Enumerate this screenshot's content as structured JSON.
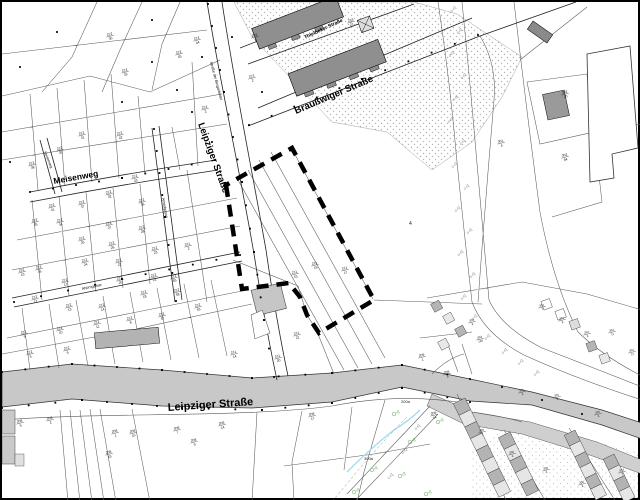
{
  "map": {
    "type": "cadastral-parcel-map",
    "streets": [
      {
        "id": "leipziger-upper",
        "label": "Leipziger Straße",
        "x": 196,
        "y": 122,
        "rotate": 70,
        "size": 9.5,
        "weight": "bold"
      },
      {
        "id": "leipziger-lower",
        "label": "Leipziger Straße",
        "x": 166,
        "y": 409,
        "rotate": -4,
        "size": 11,
        "weight": "bold"
      },
      {
        "id": "meisenweg",
        "label": "Meisenweg",
        "x": 52,
        "y": 182,
        "rotate": -10,
        "size": 8.5,
        "weight": "bold"
      },
      {
        "id": "braussweiger",
        "label": "Braußwiger Straße",
        "x": 294,
        "y": 112,
        "rotate": -23,
        "size": 9.5,
        "weight": "bold"
      },
      {
        "id": "thielbeker",
        "label": "Thielbeker Straße",
        "x": 303,
        "y": 37,
        "rotate": -25,
        "size": 5,
        "weight": "bold"
      },
      {
        "id": "bergarbeiter",
        "label": "Straße der Bergarbeiter",
        "x": 208,
        "y": 60,
        "rotate": 75,
        "size": 3.8,
        "weight": "normal"
      },
      {
        "id": "amselgasse",
        "label": "Amselgasse",
        "x": 160,
        "y": 196,
        "rotate": 80,
        "size": 3.8,
        "weight": "normal"
      },
      {
        "id": "ahorngasse",
        "label": "Ahorngasse",
        "x": 80,
        "y": 288,
        "rotate": -12,
        "size": 3.8,
        "weight": "normal"
      },
      {
        "id": "meisenweg-lane",
        "label": "Meisenweg",
        "x": 42,
        "y": 150,
        "rotate": 68,
        "size": 3.5,
        "weight": "normal"
      }
    ],
    "area_labels": [
      {
        "t": "4",
        "x": 407,
        "y": 223,
        "s": 5
      },
      {
        "t": "200a",
        "x": 399,
        "y": 401,
        "s": 4
      },
      {
        "t": "300a",
        "x": 362,
        "y": 458,
        "s": 4
      }
    ],
    "parcels": [
      [
        108,
        34,
        "212/30"
      ],
      [
        123,
        70,
        "212/33"
      ],
      [
        80,
        133,
        "212/31"
      ],
      [
        118,
        133,
        "212/42"
      ],
      [
        58,
        148,
        "212/39"
      ],
      [
        30,
        163,
        "212/38"
      ],
      [
        133,
        176,
        "212/43"
      ],
      [
        50,
        205,
        "212/41"
      ],
      [
        107,
        192,
        "212/32"
      ],
      [
        140,
        200,
        "212/36"
      ],
      [
        80,
        202,
        "212/37"
      ],
      [
        33,
        220,
        "212/35"
      ],
      [
        58,
        220,
        "212/34"
      ],
      [
        107,
        223,
        "212/27"
      ],
      [
        140,
        227,
        "212/28"
      ],
      [
        80,
        238,
        "212/25"
      ],
      [
        110,
        243,
        "212/26"
      ],
      [
        153,
        248,
        "212/23"
      ],
      [
        117,
        260,
        "212/22"
      ],
      [
        83,
        260,
        "212/24"
      ],
      [
        37,
        267,
        "212/16"
      ],
      [
        20,
        270,
        "212/15"
      ],
      [
        63,
        280,
        "212/17"
      ],
      [
        118,
        278,
        "212/20"
      ],
      [
        152,
        275,
        "212/21"
      ],
      [
        172,
        276,
        "212/55"
      ],
      [
        186,
        244,
        "211/2"
      ],
      [
        33,
        297,
        "212/12"
      ],
      [
        67,
        305,
        "212/13"
      ],
      [
        100,
        305,
        "212/14"
      ],
      [
        142,
        292,
        "212/18"
      ],
      [
        175,
        290,
        "212/58"
      ],
      [
        22,
        332,
        "212/9"
      ],
      [
        58,
        328,
        "212/10"
      ],
      [
        95,
        322,
        "212/11"
      ],
      [
        128,
        318,
        "212/8"
      ],
      [
        160,
        314,
        "212/57"
      ],
      [
        28,
        352,
        "212/5"
      ],
      [
        65,
        348,
        "212/6"
      ],
      [
        196,
        305,
        "212/53"
      ],
      [
        177,
        52,
        "212/45"
      ],
      [
        195,
        38,
        "212/44"
      ],
      [
        253,
        35,
        "202/2"
      ],
      [
        250,
        76,
        "213/2"
      ],
      [
        203,
        107,
        "214/2"
      ],
      [
        232,
        352,
        "211/14"
      ],
      [
        276,
        356,
        "211/20"
      ],
      [
        295,
        333,
        "211/21"
      ],
      [
        293,
        272,
        "211/15"
      ],
      [
        313,
        263,
        "211/16"
      ],
      [
        343,
        268,
        "211/17"
      ],
      [
        349,
        20,
        "218/27"
      ],
      [
        563,
        92,
        "302/20"
      ],
      [
        563,
        155,
        "302/84"
      ],
      [
        499,
        141,
        "301/4"
      ],
      [
        18,
        421,
        "208/5"
      ],
      [
        48,
        418,
        "208/2"
      ],
      [
        113,
        431,
        "208/1"
      ],
      [
        131,
        431,
        "208/10"
      ],
      [
        175,
        428,
        "208/7"
      ],
      [
        220,
        423,
        "208/14"
      ],
      [
        310,
        414,
        "208/17"
      ],
      [
        107,
        452,
        "208/19"
      ],
      [
        192,
        440,
        "208/9"
      ],
      [
        445,
        372,
        "209/4"
      ],
      [
        432,
        413,
        "209/14"
      ],
      [
        478,
        337,
        "303/139"
      ],
      [
        420,
        355,
        "209/1"
      ],
      [
        540,
        305,
        "304/7"
      ],
      [
        560,
        318,
        "304/8"
      ],
      [
        585,
        332,
        "304/9"
      ],
      [
        470,
        320,
        "303/9"
      ],
      [
        520,
        390,
        "305/3"
      ],
      [
        555,
        395,
        "305/4"
      ],
      [
        596,
        412,
        "305/6"
      ],
      [
        480,
        430,
        "306/2"
      ],
      [
        510,
        452,
        "306/4"
      ],
      [
        544,
        468,
        "306/6"
      ],
      [
        580,
        482,
        "306/8"
      ],
      [
        620,
        470,
        "307/2"
      ],
      [
        610,
        330,
        "304/11"
      ],
      [
        630,
        350,
        "304/12"
      ]
    ],
    "boundary_polygon": [
      [
        224,
        183
      ],
      [
        240,
        287
      ],
      [
        287,
        281
      ],
      [
        298,
        295
      ],
      [
        305,
        313
      ],
      [
        317,
        331
      ],
      [
        372,
        298
      ],
      [
        290,
        146
      ]
    ],
    "trees_gray": [
      [
        449,
        10
      ],
      [
        455,
        32
      ],
      [
        447,
        55
      ],
      [
        459,
        77
      ],
      [
        451,
        99
      ],
      [
        446,
        121
      ],
      [
        458,
        143
      ],
      [
        450,
        166
      ],
      [
        462,
        188
      ],
      [
        453,
        210
      ],
      [
        465,
        232
      ],
      [
        456,
        254
      ],
      [
        468,
        276
      ],
      [
        459,
        298
      ],
      [
        470,
        318
      ],
      [
        483,
        338
      ],
      [
        500,
        352
      ],
      [
        516,
        363
      ],
      [
        532,
        374
      ],
      [
        413,
        428
      ],
      [
        400,
        452
      ],
      [
        386,
        477
      ]
    ],
    "trees_green": [
      [
        392,
        412
      ],
      [
        408,
        440
      ],
      [
        370,
        468
      ],
      [
        398,
        474
      ],
      [
        352,
        490
      ],
      [
        424,
        492
      ],
      [
        436,
        420
      ]
    ],
    "colors": {
      "road": "#c8c8c8",
      "road2": "#cfcfcf",
      "building_dark": "#8f8f8f",
      "building_mid": "#b3b3b3",
      "building_light": "#e6e6e6",
      "stipple": "#b5b5b5",
      "stream": "#9fdcec",
      "vegetation": "#5aa85a",
      "parcel_line": "#5a5a5a",
      "boundary": "#000000"
    }
  }
}
